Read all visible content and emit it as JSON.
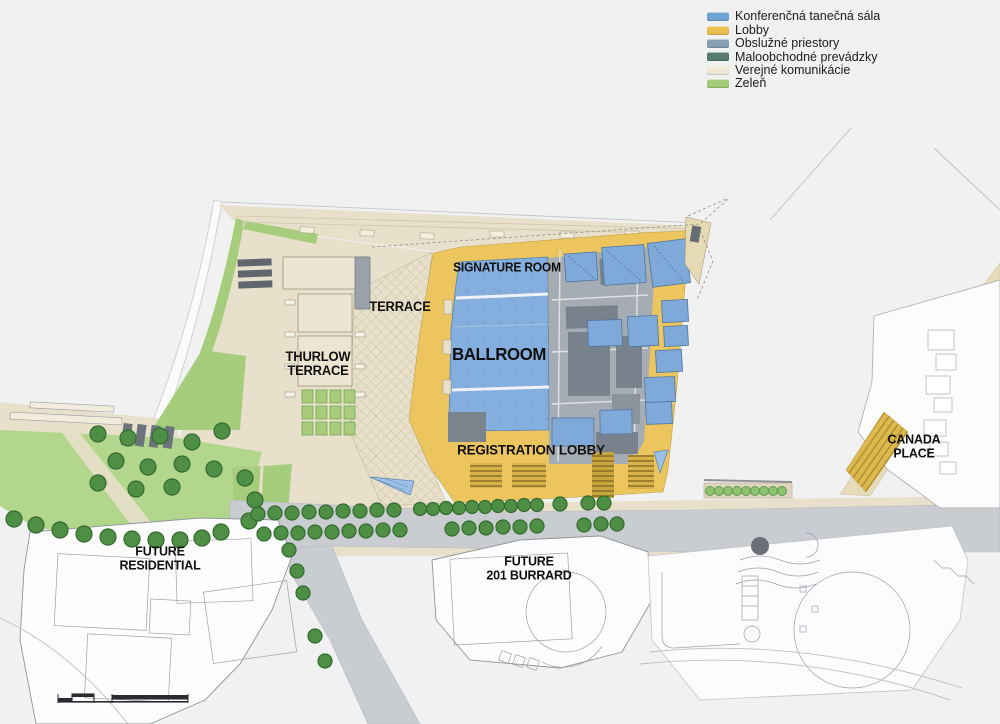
{
  "legend": {
    "items": [
      {
        "label": "Konferenčná tanečná sála",
        "color": "#6fa3d3"
      },
      {
        "label": "Lobby",
        "color": "#eabe4d"
      },
      {
        "label": "Obslužné priestory",
        "color": "#87a0b3"
      },
      {
        "label": "Maloobchodné prevádzky",
        "color": "#567a6e"
      },
      {
        "label": "Verejné komunikácie",
        "color": "#efe9d6"
      },
      {
        "label": "Zeleň",
        "color": "#a4cd7a"
      }
    ]
  },
  "map_labels": {
    "signature_room": "SIGNATURE ROOM",
    "ballroom": "BALLROOM",
    "terrace": "TERRACE",
    "thurlow_terrace": "THURLOW\nTERRACE",
    "registration_lobby": "REGISTRATION LOBBY",
    "canada_place": "CANADA\nPLACE",
    "future_residential": "FUTURE\nRESIDENTIAL",
    "future_201_burrard": "FUTURE\n201 BURRARD"
  },
  "map_colors": {
    "hall_blue": "#84aedd",
    "lobby_yellow": "#ecc55e",
    "service_gray": "#a6acb3",
    "retail_dark": "#78828c",
    "circulation_cream": "#e8e0cb",
    "green": "#a5cd7c",
    "lawn_green": "#b2d78c",
    "tree_green": "#4e8f45",
    "road_gray": "#c9ccd0",
    "background": "#f1f1f2"
  }
}
